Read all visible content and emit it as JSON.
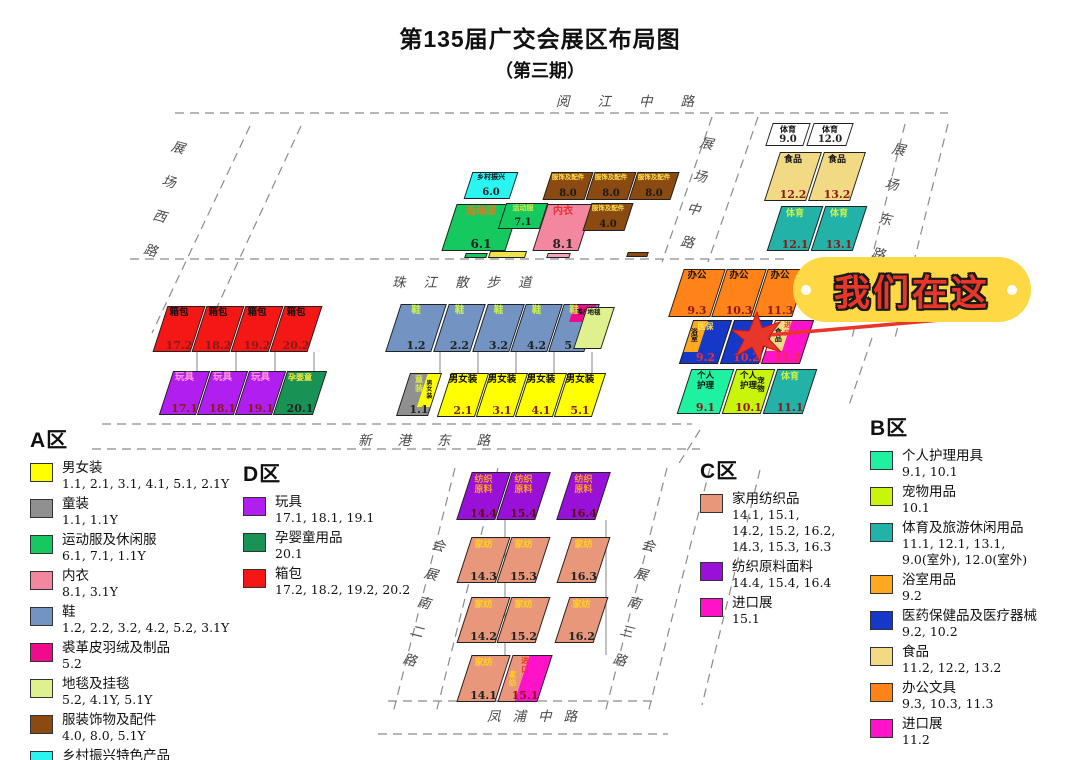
{
  "title": {
    "line1": "第135届广交会展区布局图",
    "line2": "（第三期）"
  },
  "callout": {
    "text": "我们在这",
    "bg": "#FFD945",
    "text_color": "#E8362B",
    "marker_color": "#E8362B"
  },
  "map": {
    "roads": [
      {
        "text": "阅江中路",
        "x": 556,
        "y": 90,
        "ls": 28
      },
      {
        "text": "展场西路",
        "x": 168,
        "y": 140,
        "vert": true,
        "ls": 22,
        "rot": 15
      },
      {
        "text": "展场中路",
        "x": 696,
        "y": 136,
        "vert": true,
        "ls": 20,
        "rot": 11
      },
      {
        "text": "展场东路",
        "x": 888,
        "y": 142,
        "vert": true,
        "ls": 22,
        "rot": 11
      },
      {
        "text": "珠江散步道",
        "x": 392,
        "y": 271,
        "ls": 18
      },
      {
        "text": "新港东路",
        "x": 358,
        "y": 429,
        "ls": 26
      },
      {
        "text": "会展南二路",
        "x": 428,
        "y": 538,
        "vert": true,
        "ls": 16,
        "rot": 14
      },
      {
        "text": "会展南三路",
        "x": 638,
        "y": 538,
        "vert": true,
        "ls": 16,
        "rot": 14
      },
      {
        "text": "凤浦中路",
        "x": 487,
        "y": 705,
        "ls": 12
      }
    ],
    "blocks": [
      {
        "label": "乡村振兴",
        "num": "6.0",
        "x": 468,
        "y": 172,
        "w": 46,
        "h": 27,
        "color": "#2BF5F0",
        "fs": 7,
        "nfs": 10,
        "nc": "#222"
      },
      {
        "label": "服饰及配件",
        "num": "8.0",
        "x": 547,
        "y": 172,
        "w": 42,
        "h": 28,
        "color": "#8B4A12",
        "lc": "#FFE14D",
        "fs": 6.5,
        "nfs": 10,
        "nc": "#1A1A1A"
      },
      {
        "label": "服饰及配件",
        "num": "8.0",
        "x": 590,
        "y": 172,
        "w": 42,
        "h": 28,
        "color": "#8B4A12",
        "lc": "#FFE14D",
        "fs": 6.5,
        "nfs": 10,
        "nc": "#1A1A1A"
      },
      {
        "label": "服饰及配件",
        "num": "8.0",
        "x": 633,
        "y": 172,
        "w": 42,
        "h": 28,
        "color": "#8B4A12",
        "lc": "#FFE14D",
        "fs": 6.5,
        "nfs": 10,
        "nc": "#1A1A1A"
      },
      {
        "label": "运动服",
        "num": "6.1",
        "x": 449,
        "y": 204,
        "w": 64,
        "h": 47,
        "color": "#16C95E",
        "lc": "#E87818",
        "fs": 10,
        "nfs": 12,
        "nc": "#222"
      },
      {
        "label": "运动服",
        "num": "7.1",
        "x": 502,
        "y": 203,
        "w": 42,
        "h": 26,
        "color": "#16C95E",
        "lc": "#D8E84A",
        "fs": 7,
        "nfs": 10,
        "nc": "#222"
      },
      {
        "label": "内衣",
        "num": "8.1",
        "x": 540,
        "y": 204,
        "w": 46,
        "h": 47,
        "color": "#F2879F",
        "lc": "#E83030",
        "fs": 10,
        "nfs": 12,
        "nc": "#222"
      },
      {
        "label": "服饰及配件",
        "num": "4.0",
        "x": 587,
        "y": 203,
        "w": 42,
        "h": 28,
        "color": "#8B4A12",
        "lc": "#FFE14D",
        "fs": 6.5,
        "nfs": 10,
        "nc": "#1A1A1A"
      },
      {
        "x": 465,
        "y": 253,
        "w": 22,
        "h": 5,
        "color": "#16C95E",
        "deco": true
      },
      {
        "x": 489,
        "y": 251,
        "w": 37,
        "h": 7,
        "color": "#EFE34B",
        "deco": true
      },
      {
        "x": 547,
        "y": 253,
        "w": 23,
        "h": 5,
        "color": "#F2A7B8",
        "deco": true
      },
      {
        "x": 627,
        "y": 252,
        "w": 21,
        "h": 5,
        "color": "#8B4A12",
        "deco": true
      },
      {
        "label": "体育",
        "num": "9.0",
        "x": 769,
        "y": 123,
        "w": 38,
        "h": 23,
        "color": "#FFFFFF",
        "fs": 8,
        "nfs": 10,
        "nc": "#222"
      },
      {
        "label": "体育",
        "num": "12.0",
        "x": 810,
        "y": 123,
        "w": 40,
        "h": 23,
        "color": "#FFFFFF",
        "fs": 8,
        "nfs": 10,
        "nc": "#222"
      },
      {
        "label": "食品",
        "num": "12.2",
        "x": 772,
        "y": 152,
        "w": 42,
        "h": 49,
        "color": "#F2DA85",
        "fs": 9
      },
      {
        "label": "食品",
        "num": "13.2",
        "x": 816,
        "y": 152,
        "w": 42,
        "h": 49,
        "color": "#F2DA85",
        "fs": 9
      },
      {
        "label": "体育",
        "num": "12.1",
        "x": 774,
        "y": 206,
        "w": 42,
        "h": 45,
        "color": "#22B2A8",
        "lc": "#CDF246",
        "fs": 9
      },
      {
        "label": "体育",
        "num": "13.1",
        "x": 818,
        "y": 206,
        "w": 42,
        "h": 45,
        "color": "#22B2A8",
        "lc": "#CDF246",
        "fs": 9
      },
      {
        "label": "箱包",
        "num": "17.2",
        "x": 160,
        "y": 306,
        "w": 38,
        "h": 46,
        "color": "#F51616"
      },
      {
        "label": "箱包",
        "num": "18.2",
        "x": 199,
        "y": 306,
        "w": 38,
        "h": 46,
        "color": "#F51616"
      },
      {
        "label": "箱包",
        "num": "19.2",
        "x": 238,
        "y": 306,
        "w": 38,
        "h": 46,
        "color": "#F51616"
      },
      {
        "label": "箱包",
        "num": "20.2",
        "x": 277,
        "y": 306,
        "w": 38,
        "h": 46,
        "color": "#F51616"
      },
      {
        "label": "玩具",
        "num": "17.1",
        "x": 166,
        "y": 371,
        "w": 37,
        "h": 44,
        "color": "#B01FF0",
        "lc": "#FF9AD5"
      },
      {
        "label": "玩具",
        "num": "18.1",
        "x": 204,
        "y": 371,
        "w": 37,
        "h": 44,
        "color": "#B01FF0",
        "lc": "#FF9AD5"
      },
      {
        "label": "玩具",
        "num": "19.1",
        "x": 242,
        "y": 371,
        "w": 37,
        "h": 44,
        "color": "#B01FF0",
        "lc": "#FF9AD5"
      },
      {
        "label": "孕婴童",
        "num": "20.1",
        "x": 280,
        "y": 371,
        "w": 40,
        "h": 44,
        "color": "#189355",
        "lc": "#FFE93B",
        "fs": 8,
        "nc": "#222"
      },
      {
        "label": "鞋",
        "num": "1.2",
        "x": 393,
        "y": 304,
        "w": 46,
        "h": 48,
        "color": "#7394C2",
        "lc": "#CDF246",
        "nc": "#222"
      },
      {
        "label": "鞋",
        "num": "2.2",
        "x": 441,
        "y": 304,
        "w": 37,
        "h": 48,
        "color": "#7394C2",
        "lc": "#CDF246",
        "nc": "#222"
      },
      {
        "label": "鞋",
        "num": "3.2",
        "x": 480,
        "y": 304,
        "w": 37,
        "h": 48,
        "color": "#7394C2",
        "lc": "#CDF246",
        "nc": "#222"
      },
      {
        "label": "鞋",
        "num": "4.2",
        "x": 518,
        "y": 304,
        "w": 37,
        "h": 48,
        "color": "#7394C2",
        "lc": "#CDF246",
        "nc": "#222"
      },
      {
        "label": "鞋",
        "num": "5.2",
        "x": 556,
        "y": 304,
        "w": 36,
        "h": 48,
        "color": "#7394C2",
        "lc": "#CDF246",
        "nc": "#222",
        "ov": [
          {
            "x": 30,
            "y": 0,
            "w": 64,
            "h": 36,
            "color": "#F20A8C",
            "label": "裘皮",
            "lc": "#111",
            "fs": 6
          }
        ]
      },
      {
        "label": "地毯",
        "x": 580,
        "y": 307,
        "w": 28,
        "h": 42,
        "color": "#DFF08F",
        "fs": 6.5
      },
      {
        "label": "童\n装",
        "num": "1.1",
        "x": 403,
        "y": 373,
        "w": 32,
        "h": 43,
        "color": "#909090",
        "lc": "#D9E84A",
        "nc": "#222",
        "fs": 8,
        "ov": [
          {
            "x": 58,
            "y": 0,
            "w": 46,
            "h": 80,
            "color": "#FFFF00",
            "label": "男\n女\n装",
            "lc": "#111",
            "fs": 6
          }
        ]
      },
      {
        "label": "男女装",
        "num": "2.1",
        "x": 444,
        "y": 373,
        "w": 38,
        "h": 44,
        "color": "#FFFF00",
        "fs": 9.5
      },
      {
        "label": "男女装",
        "num": "3.1",
        "x": 483,
        "y": 373,
        "w": 38,
        "h": 44,
        "color": "#FFFF00",
        "fs": 9.5
      },
      {
        "label": "男女装",
        "num": "4.1",
        "x": 522,
        "y": 373,
        "w": 38,
        "h": 44,
        "color": "#FFFF00",
        "fs": 9.5
      },
      {
        "label": "男女装",
        "num": "5.1",
        "x": 561,
        "y": 373,
        "w": 38,
        "h": 44,
        "color": "#FFFF00",
        "fs": 9.5
      },
      {
        "label": "办公",
        "num": "9.3",
        "x": 676,
        "y": 269,
        "w": 42,
        "h": 48,
        "color": "#FF8318"
      },
      {
        "label": "办公",
        "num": "10.3",
        "x": 719,
        "y": 269,
        "w": 40,
        "h": 48,
        "color": "#FF8318"
      },
      {
        "label": "办公",
        "num": "11.3",
        "x": 760,
        "y": 269,
        "w": 40,
        "h": 48,
        "color": "#FF8318"
      },
      {
        "label": "医保",
        "num": "9.2",
        "x": 686,
        "y": 320,
        "w": 39,
        "h": 44,
        "color": "#1538C9",
        "lc": "#FFE14D",
        "fs": 8,
        "nc": "#F03030",
        "ov": [
          {
            "x": -8,
            "y": 0,
            "w": 45,
            "h": 74,
            "color": "#FFA820",
            "label": "浴\n室",
            "lc": "#111",
            "fs": 7
          }
        ]
      },
      {
        "num": "10.2",
        "x": 727,
        "y": 320,
        "w": 39,
        "h": 44,
        "color": "#1538C9",
        "nc": "#F03030"
      },
      {
        "label": "进\n口",
        "num": "11.2",
        "x": 768,
        "y": 320,
        "w": 39,
        "h": 44,
        "color": "#FF12C8",
        "lc": "#F03030",
        "fs": 7,
        "nc": "#F03030",
        "ov": [
          {
            "x": -4,
            "y": 0,
            "w": 46,
            "h": 72,
            "color": "#F2DA85",
            "label": "食\n品",
            "lc": "#111",
            "fs": 7
          }
        ]
      },
      {
        "label": "个人\n护理",
        "num": "9.1",
        "x": 684,
        "y": 369,
        "w": 43,
        "h": 45,
        "color": "#1EF2A0",
        "fs": 8.5
      },
      {
        "label": "个人\n护理",
        "num": "10.1",
        "x": 729,
        "y": 369,
        "w": 39,
        "h": 45,
        "color": "#C9F50A",
        "fs": 8.5,
        "ov": [
          {
            "x": 58,
            "y": 0,
            "w": 42,
            "h": 70,
            "color": "transparent",
            "label": "宠\n物",
            "lc": "#111",
            "fs": 7.5
          }
        ]
      },
      {
        "label": "体育",
        "num": "11.1",
        "x": 770,
        "y": 369,
        "w": 40,
        "h": 45,
        "color": "#22B2A8",
        "lc": "#CDF246",
        "fs": 9
      },
      {
        "label": "纺织\n原料",
        "num": "14.4",
        "x": 464,
        "y": 472,
        "w": 39,
        "h": 48,
        "color": "#9911D9",
        "lc": "#FF9C1E",
        "fs": 9,
        "nc": "#5A1010"
      },
      {
        "label": "纺织\n原料",
        "num": "15.4",
        "x": 504,
        "y": 472,
        "w": 39,
        "h": 48,
        "color": "#9911D9",
        "lc": "#FF9C1E",
        "fs": 9,
        "nc": "#5A1010"
      },
      {
        "label": "纺织\n原料",
        "num": "16.4",
        "x": 564,
        "y": 472,
        "w": 39,
        "h": 48,
        "color": "#9911D9",
        "lc": "#FF9C1E",
        "fs": 9,
        "nc": "#5A1010"
      },
      {
        "label": "家纺",
        "num": "14.3",
        "x": 464,
        "y": 537,
        "w": 39,
        "h": 46,
        "color": "#E8977B",
        "lc": "#FFD21E",
        "fs": 9,
        "nc": "#222"
      },
      {
        "label": "家纺",
        "num": "15.3",
        "x": 504,
        "y": 537,
        "w": 39,
        "h": 46,
        "color": "#E8977B",
        "lc": "#FFD21E",
        "fs": 9,
        "nc": "#222"
      },
      {
        "label": "家纺",
        "num": "16.3",
        "x": 564,
        "y": 537,
        "w": 39,
        "h": 46,
        "color": "#E8977B",
        "lc": "#FFD21E",
        "fs": 9,
        "nc": "#222"
      },
      {
        "label": "家纺",
        "num": "14.2",
        "x": 464,
        "y": 597,
        "w": 39,
        "h": 46,
        "color": "#E8977B",
        "lc": "#FFD21E",
        "fs": 9,
        "nc": "#222"
      },
      {
        "label": "家纺",
        "num": "15.2",
        "x": 504,
        "y": 597,
        "w": 39,
        "h": 46,
        "color": "#E8977B",
        "lc": "#FFD21E",
        "fs": 9,
        "nc": "#222"
      },
      {
        "label": "家纺",
        "num": "16.2",
        "x": 562,
        "y": 597,
        "w": 39,
        "h": 46,
        "color": "#E8977B",
        "lc": "#FFD21E",
        "fs": 9,
        "nc": "#222"
      },
      {
        "label": "家纺",
        "num": "14.1",
        "x": 464,
        "y": 655,
        "w": 39,
        "h": 47,
        "color": "#E8977B",
        "lc": "#FFD21E",
        "fs": 9,
        "nc": "#222"
      },
      {
        "label": "进\n口",
        "num": "15.1",
        "x": 505,
        "y": 655,
        "w": 40,
        "h": 47,
        "color": "#FF12C8",
        "lc": "#F03030",
        "fs": 7.5,
        "ov": [
          {
            "x": -6,
            "y": 0,
            "w": 48,
            "h": 100,
            "color": "#E8977B",
            "label": "家\n纺",
            "lc": "#FFD21E",
            "fs": 7.5
          }
        ]
      }
    ]
  },
  "legends": [
    {
      "title": "A区",
      "x": 30,
      "y": 424,
      "items": [
        {
          "color": "#FFFF00",
          "name": "男女装",
          "nums": "1.1, 2.1, 3.1, 4.1, 5.1, 2.1Y"
        },
        {
          "color": "#909090",
          "name": "童装",
          "nums": "1.1, 1.1Y"
        },
        {
          "color": "#16C95E",
          "name": "运动服及休闲服",
          "nums": "6.1, 7.1, 1.1Y"
        },
        {
          "color": "#F2879F",
          "name": "内衣",
          "nums": "8.1, 3.1Y"
        },
        {
          "color": "#7394C2",
          "name": "鞋",
          "nums": "1.2, 2.2, 3.2, 4.2, 5.2, 3.1Y"
        },
        {
          "color": "#F20A8C",
          "name": "裘革皮羽绒及制品",
          "nums": "5.2"
        },
        {
          "color": "#DFF08F",
          "name": "地毯及挂毯",
          "nums": "5.2, 4.1Y, 5.1Y"
        },
        {
          "color": "#8B4A12",
          "name": "服装饰物及配件",
          "nums": "4.0, 8.0, 5.1Y"
        },
        {
          "color": "#2BF5F0",
          "name": "乡村振兴特色产品",
          "nums": "6.0"
        }
      ]
    },
    {
      "title": "D区",
      "x": 243,
      "y": 458,
      "items": [
        {
          "color": "#B01FF0",
          "name": "玩具",
          "nums": "17.1, 18.1, 19.1"
        },
        {
          "color": "#189355",
          "name": "孕婴童用品",
          "nums": "20.1"
        },
        {
          "color": "#F51616",
          "name": "箱包",
          "nums": "17.2, 18.2, 19.2, 20.2"
        }
      ]
    },
    {
      "title": "C区",
      "x": 700,
      "y": 455,
      "items": [
        {
          "color": "#E8977B",
          "name": "家用纺织品",
          "nums": "14.1, 15.1,\n14.2, 15.2, 16.2,\n14.3, 15.3, 16.3"
        },
        {
          "color": "#9911D9",
          "name": "纺织原料面料",
          "nums": "14.4, 15.4, 16.4"
        },
        {
          "color": "#FF12C8",
          "name": "进口展",
          "nums": "15.1"
        }
      ]
    },
    {
      "title": "B区",
      "x": 870,
      "y": 412,
      "items": [
        {
          "color": "#1EF2A0",
          "name": "个人护理用具",
          "nums": "9.1, 10.1"
        },
        {
          "color": "#C9F50A",
          "name": "宠物用品",
          "nums": "10.1"
        },
        {
          "color": "#22B2A8",
          "name": "体育及旅游休闲用品",
          "nums": "11.1, 12.1, 13.1,\n9.0(室外), 12.0(室外)"
        },
        {
          "color": "#FFA820",
          "name": "浴室用品",
          "nums": "9.2"
        },
        {
          "color": "#1538C9",
          "name": "医药保健品及医疗器械",
          "nums": "9.2, 10.2"
        },
        {
          "color": "#F2DA85",
          "name": "食品",
          "nums": "11.2, 12.2, 13.2"
        },
        {
          "color": "#FF8318",
          "name": "办公文具",
          "nums": "9.3, 10.3, 11.3"
        },
        {
          "color": "#FF12C8",
          "name": "进口展",
          "nums": "11.2"
        }
      ]
    }
  ]
}
